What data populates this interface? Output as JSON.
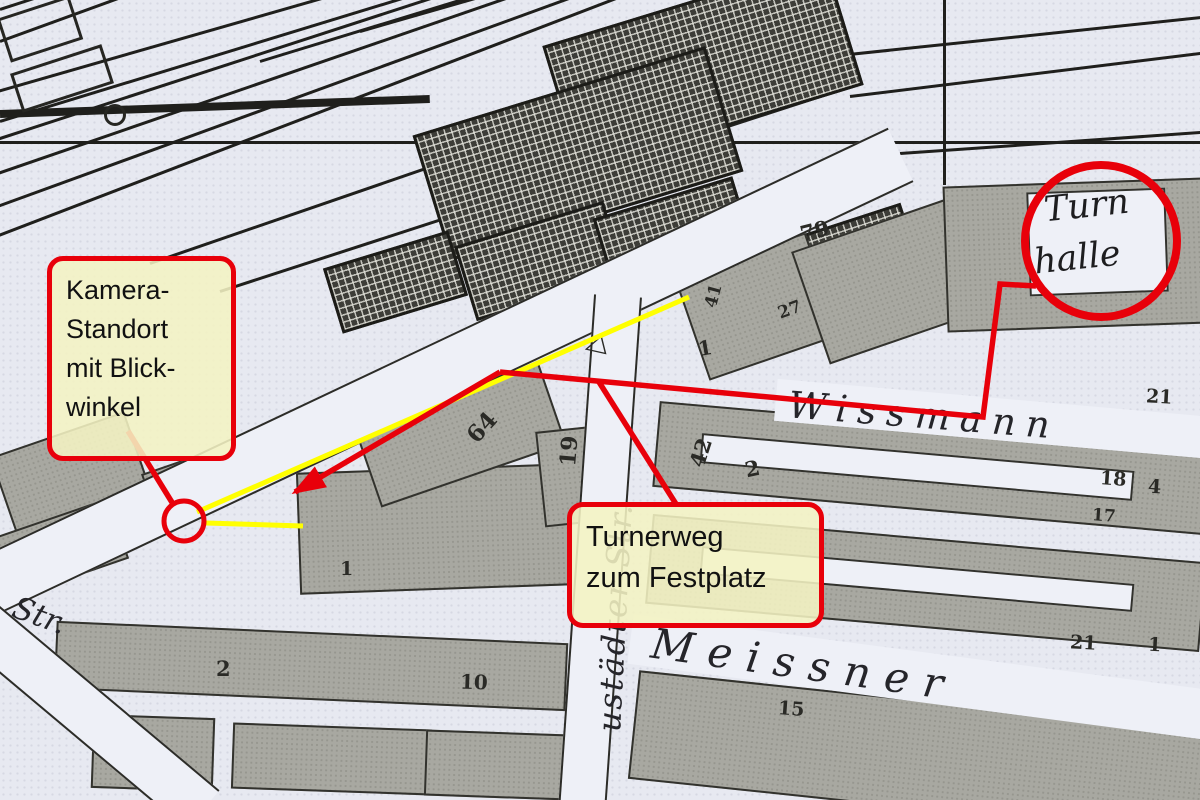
{
  "colors": {
    "annotation_red": "#e8000a",
    "view_yellow": "#ffff00",
    "map_bg": "#e7e9f1",
    "building_fill": "#a8a8a1",
    "note_bg": "rgba(244,243,195,0.88)"
  },
  "annotations": {
    "camera_note": {
      "lines": [
        "Kamera-",
        "Standort",
        "mit Blick-",
        "winkel"
      ]
    },
    "path_note": {
      "lines": [
        "Turnerweg",
        "zum Festplatz"
      ]
    }
  },
  "map": {
    "turnhalle_label": {
      "line1": "Turn",
      "line2": "halle"
    },
    "streets": {
      "wissmann": "Wissmann",
      "meissner": "Meissner",
      "neustaedter": "ustädter Str.",
      "str_left": "Str."
    },
    "icons": {
      "survey_triangle": "◁"
    },
    "house_numbers": [
      {
        "text": "79",
        "x": 800,
        "y": 218,
        "rot": -14,
        "size": 21
      },
      {
        "text": "41",
        "x": 702,
        "y": 286,
        "rot": -75,
        "size": 17
      },
      {
        "text": "27",
        "x": 778,
        "y": 300,
        "rot": -20,
        "size": 17
      },
      {
        "text": "1",
        "x": 698,
        "y": 336,
        "rot": -10,
        "size": 20
      },
      {
        "text": "21",
        "x": 1146,
        "y": 386,
        "rot": 3,
        "size": 19
      },
      {
        "text": "64",
        "x": 466,
        "y": 414,
        "rot": -48,
        "size": 23
      },
      {
        "text": "19",
        "x": 554,
        "y": 438,
        "rot": -85,
        "size": 22
      },
      {
        "text": "42",
        "x": 686,
        "y": 440,
        "rot": -72,
        "size": 21
      },
      {
        "text": "2",
        "x": 745,
        "y": 456,
        "rot": -12,
        "size": 21
      },
      {
        "text": "18",
        "x": 1100,
        "y": 468,
        "rot": 4,
        "size": 19
      },
      {
        "text": "4",
        "x": 1148,
        "y": 476,
        "rot": 4,
        "size": 19
      },
      {
        "text": "17",
        "x": 1092,
        "y": 506,
        "rot": 4,
        "size": 17
      },
      {
        "text": "21",
        "x": 1070,
        "y": 632,
        "rot": 3,
        "size": 19
      },
      {
        "text": "1",
        "x": 1148,
        "y": 634,
        "rot": 3,
        "size": 19
      },
      {
        "text": "15",
        "x": 778,
        "y": 698,
        "rot": 4,
        "size": 19
      },
      {
        "text": "10",
        "x": 460,
        "y": 670,
        "rot": 2,
        "size": 20
      },
      {
        "text": "2",
        "x": 216,
        "y": 656,
        "rot": 0,
        "size": 21
      },
      {
        "text": "1",
        "x": 340,
        "y": 558,
        "rot": 0,
        "size": 19
      }
    ]
  }
}
